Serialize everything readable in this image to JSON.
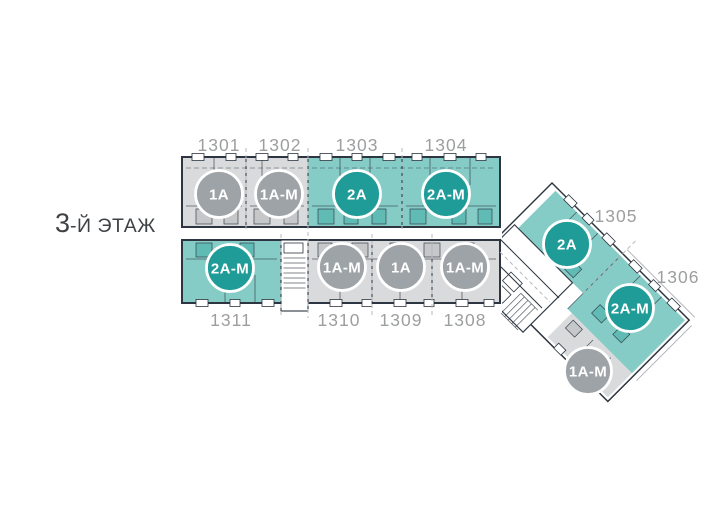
{
  "title": {
    "number": "3",
    "suffix": "-Й ЭТАЖ"
  },
  "colors": {
    "badge_teal": "#1f9c98",
    "badge_gray": "#9da3a7",
    "fill_teal": "#85ccc7",
    "fill_teal_dark": "#5dbab4",
    "fill_gray": "#d8dadb",
    "fill_gray_dark": "#c3c6c8",
    "outline": "#2c3540",
    "label": "#9c9ea0",
    "leader": "#b6b9bc",
    "title": "#3e4245"
  },
  "units": [
    {
      "number": "1301",
      "type": "1A",
      "style": "gray"
    },
    {
      "number": "1302",
      "type": "1A-M",
      "style": "gray"
    },
    {
      "number": "1303",
      "type": "2A",
      "style": "teal"
    },
    {
      "number": "1304",
      "type": "2A-M",
      "style": "teal"
    },
    {
      "number": "1305",
      "type": "2A",
      "style": "teal"
    },
    {
      "number": "1306",
      "type": "2A-M",
      "style": "teal"
    },
    {
      "number": "",
      "type": "1A-M",
      "style": "gray"
    },
    {
      "number": "1308",
      "type": "1A-M",
      "style": "gray"
    },
    {
      "number": "1309",
      "type": "1A",
      "style": "gray"
    },
    {
      "number": "1310",
      "type": "1A-M",
      "style": "gray"
    },
    {
      "number": "1311",
      "type": "2A-M",
      "style": "teal"
    }
  ]
}
